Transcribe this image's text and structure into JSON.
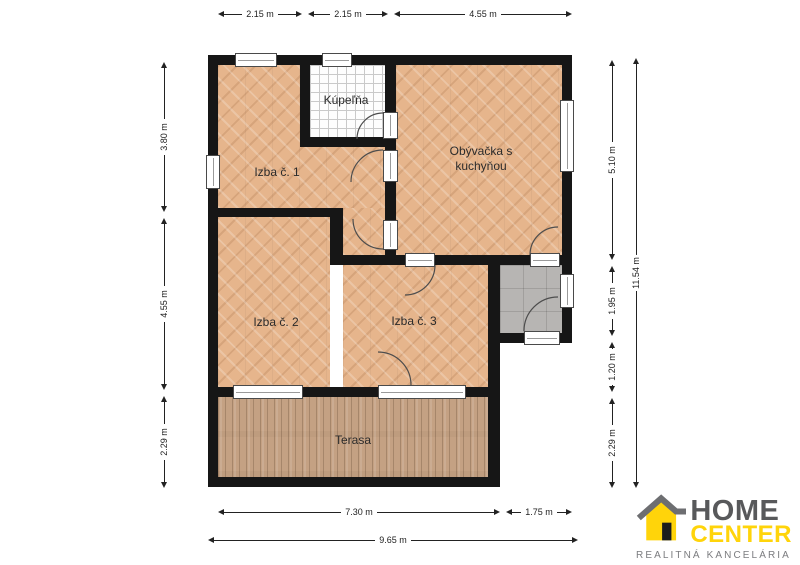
{
  "rooms": [
    {
      "id": "izba-1",
      "label": "Izba č. 1"
    },
    {
      "id": "kupelna",
      "label": "Kúpeľňa"
    },
    {
      "id": "obyvacka",
      "label": "Obývačka s kuchyňou"
    },
    {
      "id": "izba-2",
      "label": "Izba č. 2"
    },
    {
      "id": "izba-3",
      "label": "Izba č. 3"
    },
    {
      "id": "terasa",
      "label": "Terasa"
    }
  ],
  "dimensions": {
    "top": [
      "2.15 m",
      "2.15 m",
      "4.55 m"
    ],
    "left": [
      "3.80 m",
      "4.55 m",
      "2.29 m"
    ],
    "right": [
      "5.10 m",
      "1.95 m",
      "1.20 m",
      "2.29 m"
    ],
    "right_total": "11.54 m",
    "bottom": [
      "7.30 m",
      "1.75 m"
    ],
    "bottom_total": "9.65 m"
  },
  "logo": {
    "word1": "HOME",
    "word2": "CENTER",
    "tagline": "REALITNÁ KANCELÁRIA"
  },
  "colors": {
    "wall": "#161616",
    "wood_floor": "#e6b58c",
    "deck_floor": "#c4a183",
    "bath_tile": "#fdfdfd",
    "entry_tile": "#b7b5b3",
    "dimension_text": "#222222",
    "logo_gray": "#58595b",
    "logo_yellow": "#ffd40a",
    "tagline_gray": "#7b7c7f"
  }
}
